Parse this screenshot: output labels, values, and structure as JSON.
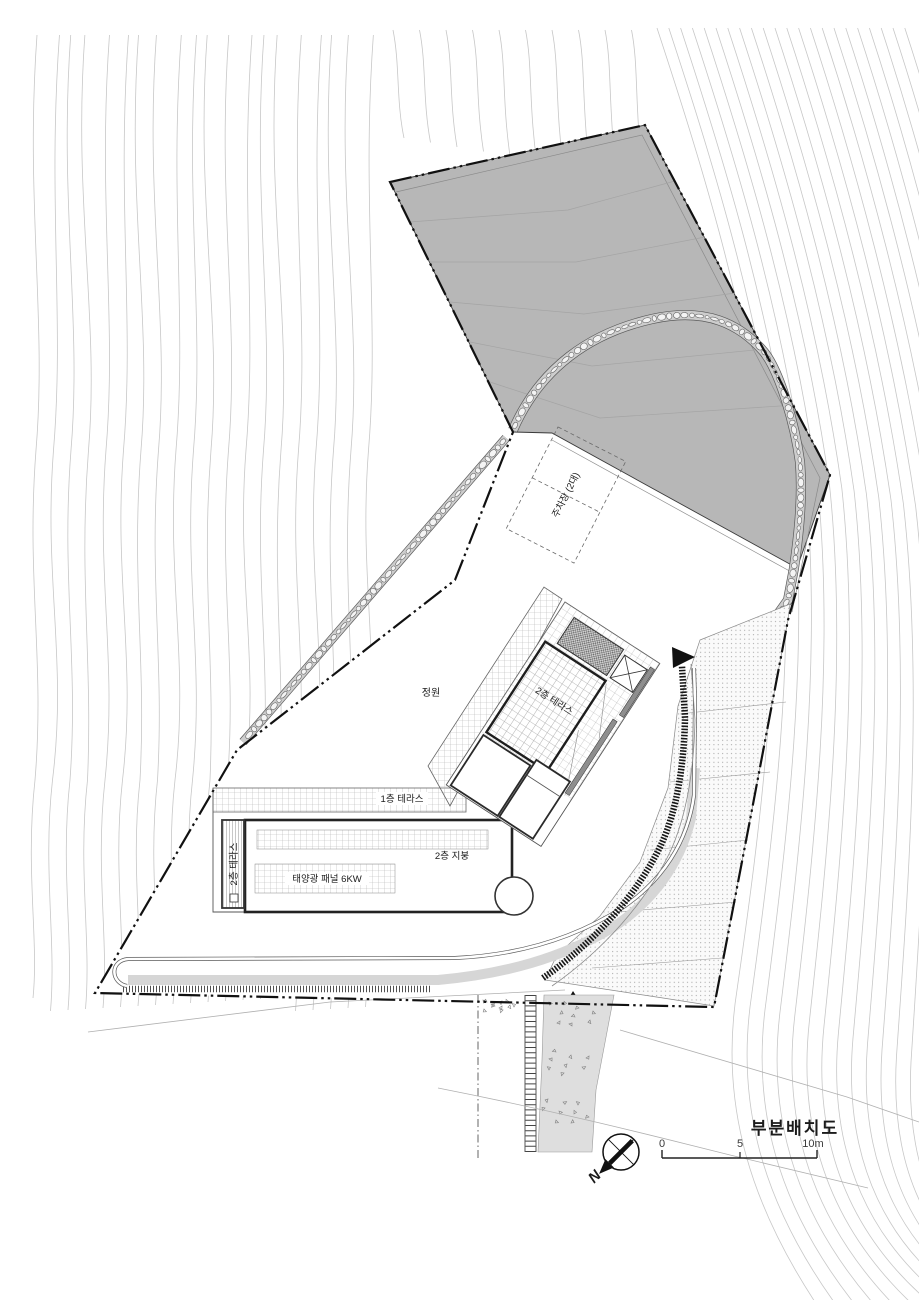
{
  "title": "부분배치도",
  "compass": {
    "north": "N"
  },
  "scale_bar": {
    "ticks": [
      "0",
      "5",
      "10m"
    ]
  },
  "labels": {
    "garden": "정원",
    "parking": "주차장 (2대)",
    "terrace_2f_upper": "2층 테라스",
    "terrace_2f_left": "2층 테라스",
    "terrace_1f": "1층 테라스",
    "roof_2f": "2층 지붕",
    "solar": "태양광 패널 6KW"
  },
  "colors": {
    "slope_fill": "#b7b7b7",
    "road_band": "#d6d6d6",
    "line_dark": "#1b1b1b",
    "contour": "#c7c7c7"
  }
}
